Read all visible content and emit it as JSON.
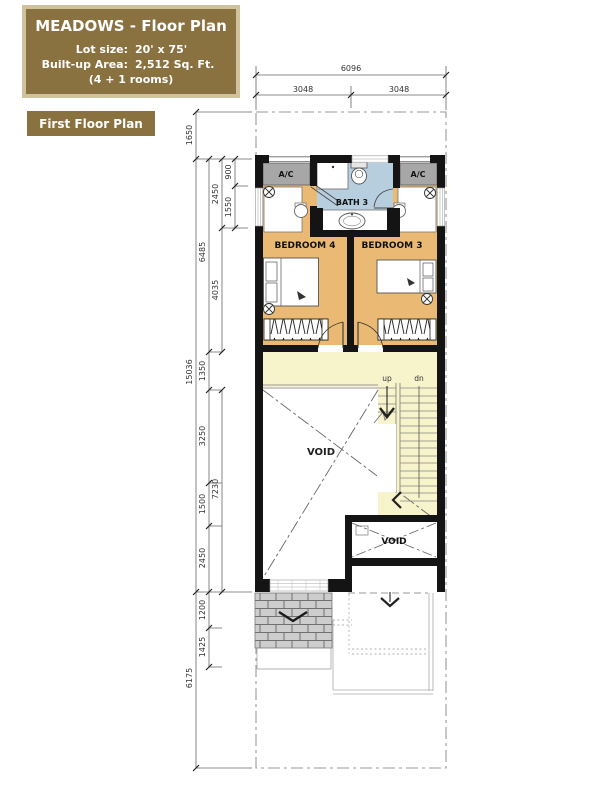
{
  "header": {
    "title": "MEADOWS - Floor Plan",
    "lot_size_label": "Lot size:",
    "lot_size_value": "20' x 75'",
    "built_up_label": "Built-up Area:",
    "built_up_value": "2,512 Sq. Ft.",
    "rooms_note": "(4 + 1 rooms)"
  },
  "plan_label": "First Floor Plan",
  "rooms": {
    "bedroom4": "BEDROOM 4",
    "bedroom3": "BEDROOM 3",
    "bath3": "BATH 3",
    "ac_left": "A/C",
    "ac_right": "A/C",
    "void_main": "VOID",
    "void_small": "VOID",
    "up": "up",
    "dn": "dn"
  },
  "dims": {
    "top": {
      "total": "6096",
      "left": "3048",
      "right": "3048"
    },
    "left_outer": [
      "1650",
      "15036",
      "6175"
    ],
    "left_mid": [
      "6485",
      "1350",
      "3250",
      "1500",
      "2450",
      "1200",
      "1425"
    ],
    "left_inner": [
      "2450",
      "4035",
      "7230"
    ],
    "left_innermost": [
      "900",
      "1550"
    ]
  },
  "colors": {
    "header_bg": "#8a7140",
    "header_border": "#cfc29c",
    "wall": "#141414",
    "bedroom_floor": "#eaba74",
    "hall_floor": "#f7f3cb",
    "bath_floor": "#b7cedf",
    "ac_ledge": "#a7a7a7"
  }
}
